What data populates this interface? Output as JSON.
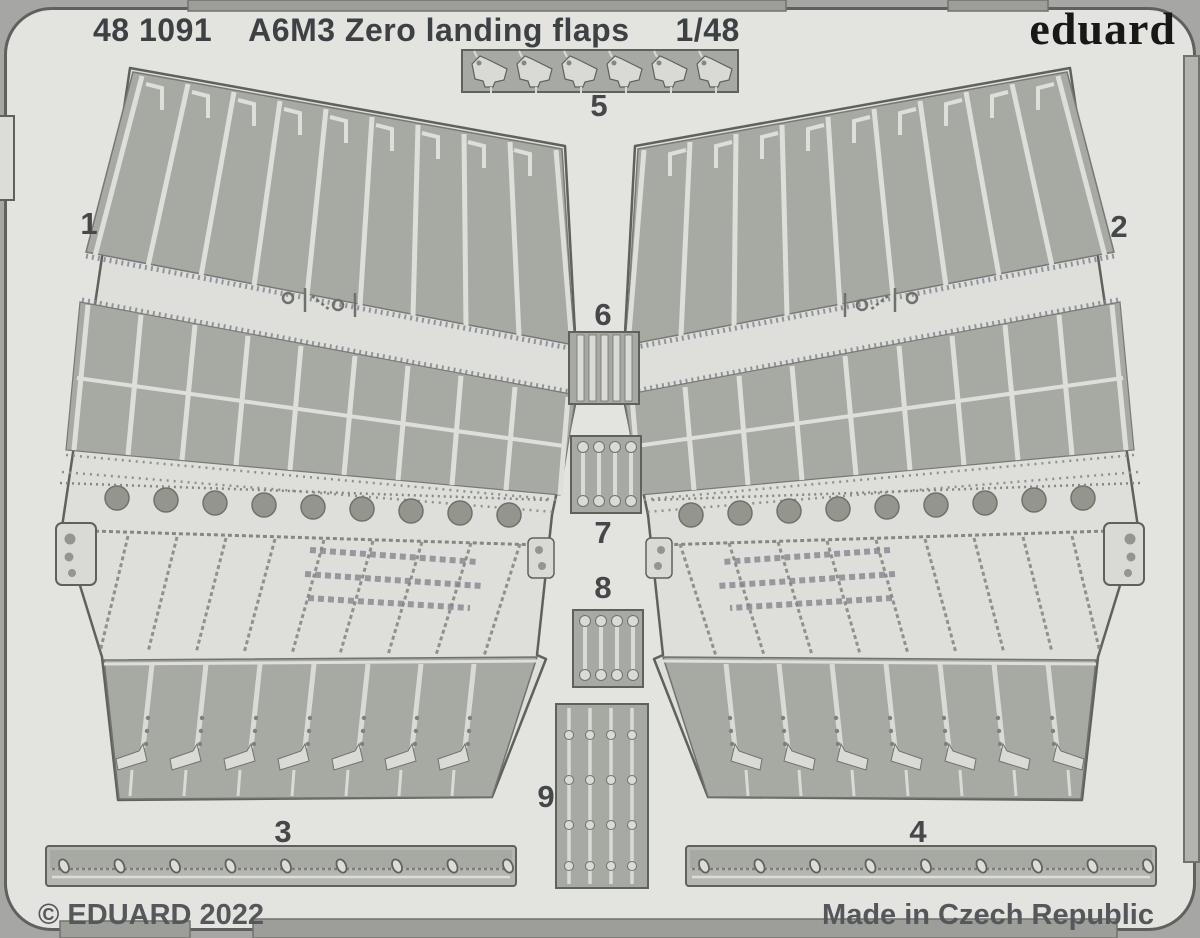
{
  "header": {
    "catalog_number": "48 1091",
    "product_title": "A6M3 Zero landing flaps",
    "scale": "1/48",
    "brand_logo": "eduard"
  },
  "footer": {
    "copyright": "© EDUARD 2022",
    "made_in": "Made in Czech Republic"
  },
  "part_labels": {
    "1": "1",
    "2": "2",
    "3": "3",
    "4": "4",
    "5": "5",
    "6": "6",
    "7": "7",
    "8": "8",
    "9": "9"
  },
  "colors": {
    "background": "#a6a6a4",
    "sheet": "#e3e3e0",
    "etched_recess": "#a7a9a3",
    "part_light": "#dadbd6",
    "outline": "#5f625c",
    "text": "#3e4144"
  }
}
